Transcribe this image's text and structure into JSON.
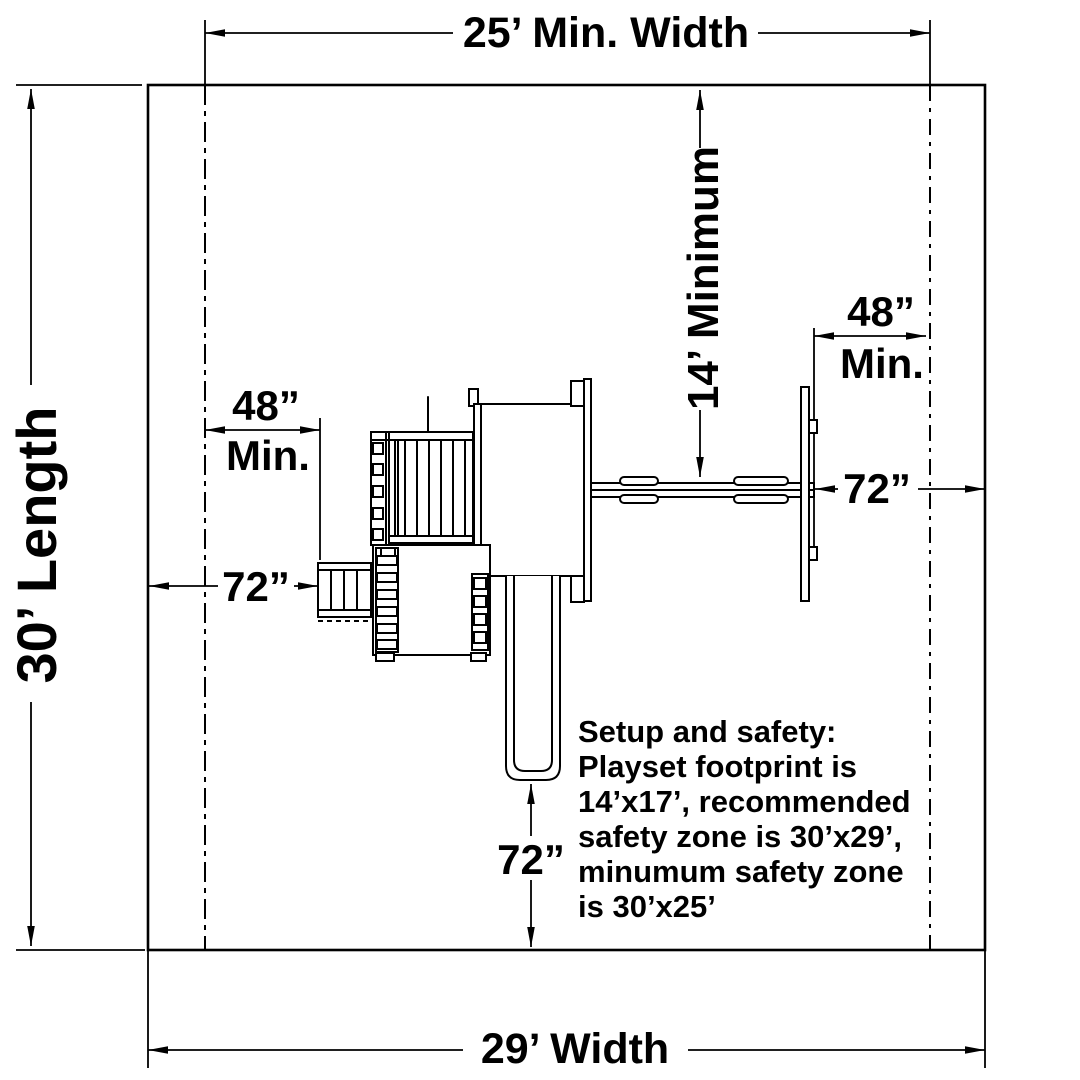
{
  "colors": {
    "background": "#ffffff",
    "line": "#000000"
  },
  "dimensions": {
    "top_width": "25’ Min. Width",
    "bottom_width": "29’ Width",
    "left_length": "30’ Length",
    "swing_vertical": "14’ Minimum",
    "left_48": "48”",
    "left_48_min": "Min.",
    "left_72": "72”",
    "right_48": "48”",
    "right_48_min": "Min.",
    "right_72": "72”",
    "slide_72": "72”"
  },
  "note": {
    "lines": [
      "Setup and safety:",
      "Playset footprint is",
      "14’x17’, recommended",
      "safety zone is 30’x29’,",
      "minumum safety zone",
      "is 30’x25’"
    ]
  }
}
